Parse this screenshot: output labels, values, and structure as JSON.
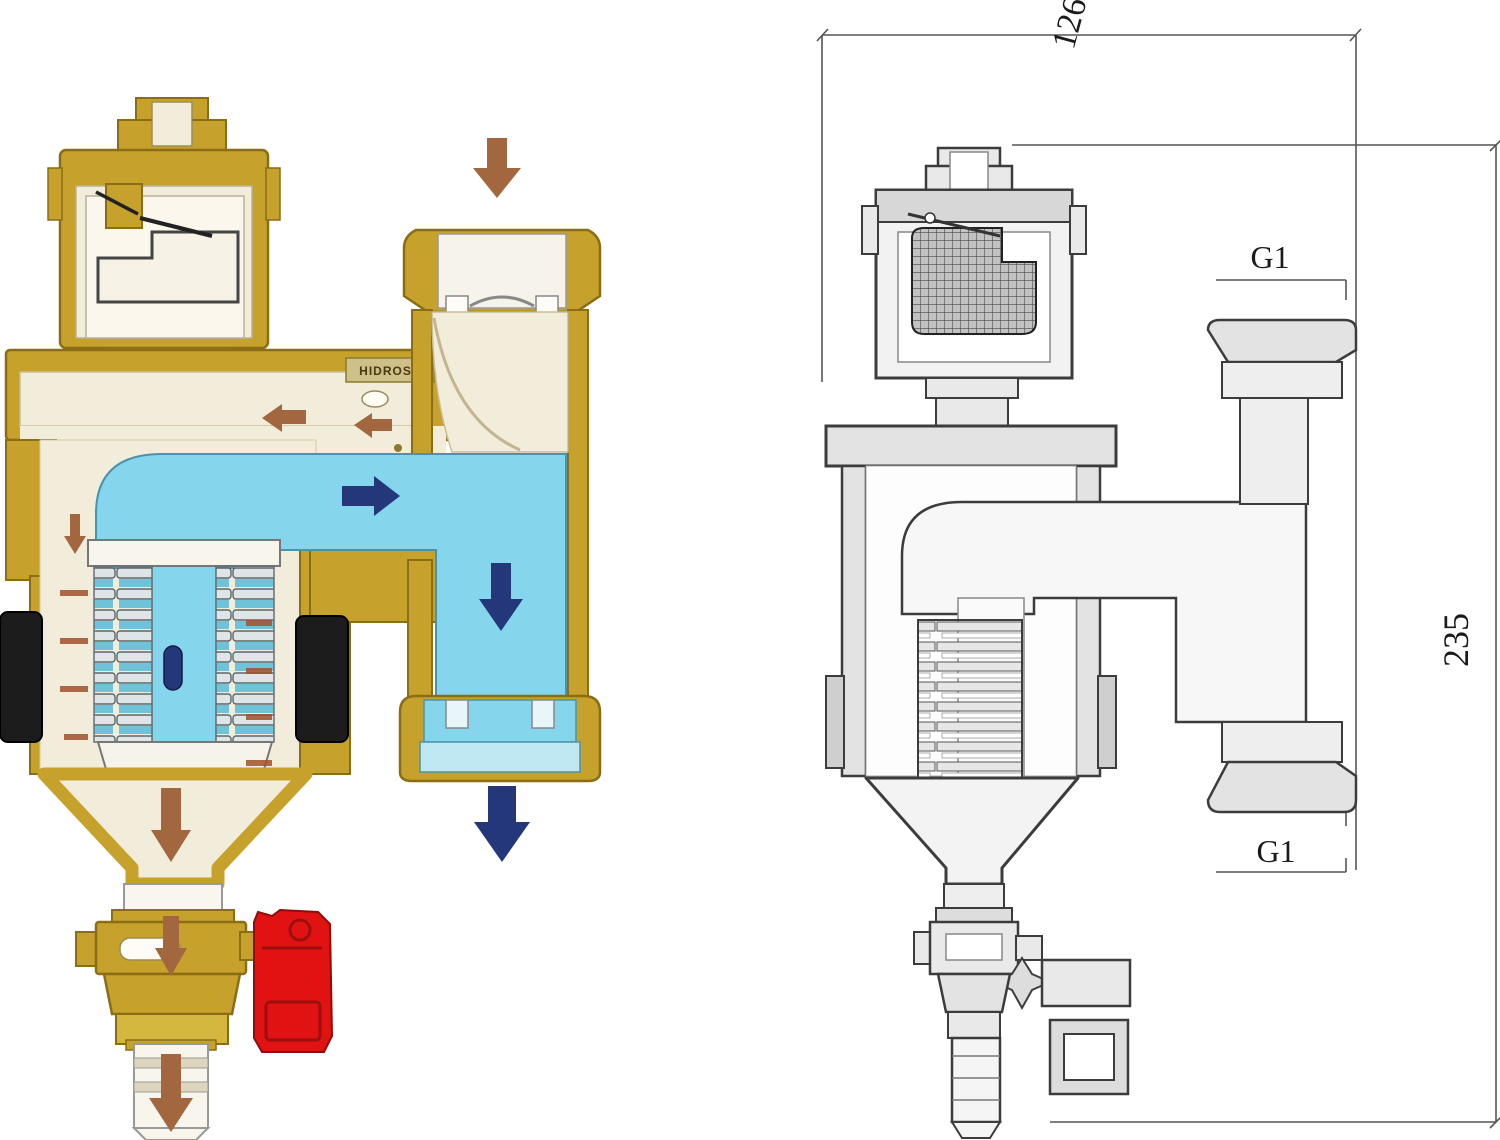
{
  "page": {
    "width_px": 1500,
    "height_px": 1140,
    "background": "#ffffff"
  },
  "left_diagram": {
    "kind": "colored cutaway illustration",
    "subject": "magnetic dirt separator filter valve with automatic air vent and drain cock",
    "brand_plate": "HIDROSS",
    "colors": {
      "brass": "#c6a22c",
      "brass_dark": "#8a6d14",
      "brass_light": "#dec04a",
      "body_cream": "#f2ecdb",
      "chamber_white": "#fbf7ec",
      "water_cyan": "#85d5ec",
      "water_cyan_light": "#bfe8f2",
      "arrow_brown": "#a2673f",
      "arrow_navy": "#24377b",
      "magnet_black": "#1c1c1c",
      "drain_red": "#e01212",
      "mesh_slat_gray": "#dfe5e7",
      "mesh_slat_teal": "#6fc3d8"
    },
    "flow_arrows": [
      {
        "name": "inlet-flow",
        "direction": "down",
        "color_role": "arrow_brown"
      },
      {
        "name": "bypass-flow-a",
        "direction": "left",
        "color_role": "arrow_brown"
      },
      {
        "name": "bypass-flow-b",
        "direction": "left",
        "color_role": "arrow_brown"
      },
      {
        "name": "main-flow",
        "direction": "right",
        "color_role": "arrow_navy"
      },
      {
        "name": "down-channel-flow",
        "direction": "down",
        "color_role": "arrow_navy"
      },
      {
        "name": "outlet-flow",
        "direction": "down",
        "color_role": "arrow_navy"
      },
      {
        "name": "wall-seep-flow",
        "direction": "down",
        "color_role": "arrow_brown"
      },
      {
        "name": "settling-flow",
        "direction": "down",
        "color_role": "arrow_brown"
      },
      {
        "name": "drain-flow",
        "direction": "down",
        "color_role": "arrow_brown"
      },
      {
        "name": "hose-outlet-flow",
        "direction": "down",
        "color_role": "arrow_brown"
      }
    ]
  },
  "right_diagram": {
    "kind": "engineering cross-section line drawing with dimensions",
    "line_color": "#3c3c3c",
    "dimensions": {
      "overall_width": "126",
      "overall_height": "235",
      "top_port_thread": "G1",
      "bottom_port_thread": "G1"
    }
  }
}
